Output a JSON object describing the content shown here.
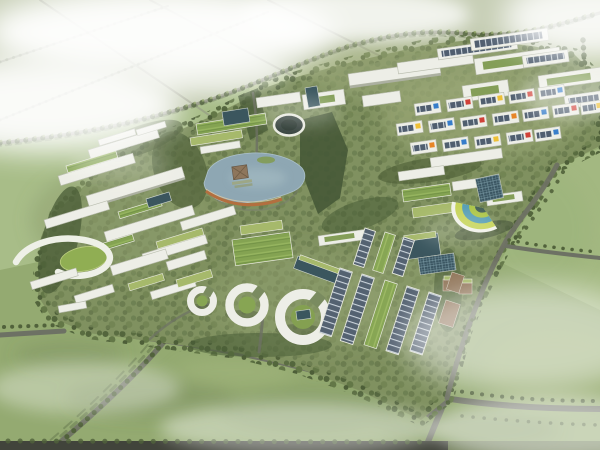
{
  "meta": {
    "type": "architectural-aerial-rendering",
    "subject": "Bird's-eye rendering of an eco industrial park master plan surrounded by farmland, tree-lined roads and fog",
    "canvas": {
      "width": 600,
      "height": 450
    }
  },
  "palette": {
    "field_pale": "#c5cdb3",
    "field_light": "#a5bb84",
    "field_mid": "#9db77c",
    "field_bottom": "#90a76c",
    "road_field": "#8d907d",
    "road_campus": "#686c5e",
    "road_dark": "#3a3d33",
    "tree_dark": "#4a5c33",
    "tree_shadow": "#3c4b2a",
    "campus_green": "#7b8d5a",
    "building_white": "#edeee6",
    "building_edge": "#b6baab",
    "green_roof": "#7fa04b",
    "green_roof_light": "#a3b765",
    "solar_panel": "#49586a",
    "solar_frame": "#c8d2da",
    "glass_teal": "#335058",
    "tan": "#8d7154",
    "pond": "#8aa4b0",
    "pond_walkway_orange": "#b06a38",
    "lawn": "#8cab4c",
    "accent_red": "#cf3a30",
    "accent_blue": "#2f78c8",
    "accent_yellow": "#eebe2e",
    "accent_orange": "#e6801f",
    "fan_lime": "#c3d24f",
    "fan_teal": "#4f9ab2",
    "fog": "#ffffff"
  },
  "scene": {
    "regions": [
      "hazy-farmland-grid-top-left",
      "tree-lined-arterial-road",
      "green-fields",
      "eco-campus-core",
      "warehouse-slab-row",
      "colored-accent-office-blocks",
      "central-pond-with-orange-walkway",
      "circular-plaza-building",
      "fan-shaped-striped-building",
      "ring-courtyard-buildings",
      "solar-roof-rows",
      "green-roof-terraces",
      "perimeter-roads-and-fog"
    ]
  }
}
